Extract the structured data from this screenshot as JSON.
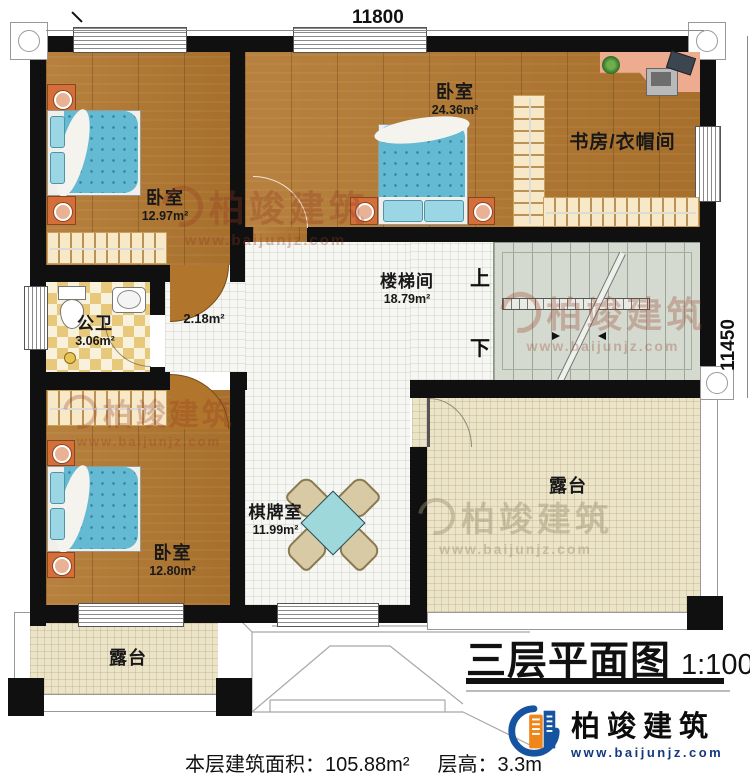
{
  "dimensions": {
    "top": "11800",
    "right": "11450"
  },
  "rooms": {
    "bedroom_tl": {
      "name": "卧室",
      "area": "12.97m²"
    },
    "bedroom_tr": {
      "name": "卧室",
      "area": "24.36m²"
    },
    "study": {
      "name": "书房/衣帽间"
    },
    "stairwell": {
      "name": "楼梯间",
      "area": "18.79m²"
    },
    "bathroom": {
      "name": "公卫",
      "area": "3.06m²"
    },
    "hallway": {
      "area": "2.18m²"
    },
    "chess_room": {
      "name": "棋牌室",
      "area": "11.99m²"
    },
    "bedroom_bl": {
      "name": "卧室",
      "area": "12.80m²"
    },
    "terrace_right": {
      "name": "露台"
    },
    "terrace_bottom": {
      "name": "露台"
    }
  },
  "stairs": {
    "up": "上",
    "down": "下"
  },
  "title": {
    "text": "三层平面图",
    "scale": "1:100"
  },
  "footer": {
    "area_label": "本层建筑面积：",
    "area_value": "105.88m²",
    "height_label": "层高：",
    "height_value": "3.3m"
  },
  "logo": {
    "name": "柏竣建筑",
    "url": "www.baijunjz.com"
  },
  "watermark": {
    "text": "柏竣建筑",
    "url": "www.baijunjz.com"
  },
  "colors": {
    "wood": "#b1762e",
    "tile": "#f6f6f3",
    "terrace": "#ece4c8",
    "stairs": "#d4dacf",
    "wall": "#101010",
    "bed_blue": "#63bad2",
    "table_teal": "#9ed8da",
    "desk_salmon": "#edab90",
    "logo_blue": "#1653a0",
    "logo_orange": "#f08519",
    "watermark": "#96402a"
  }
}
